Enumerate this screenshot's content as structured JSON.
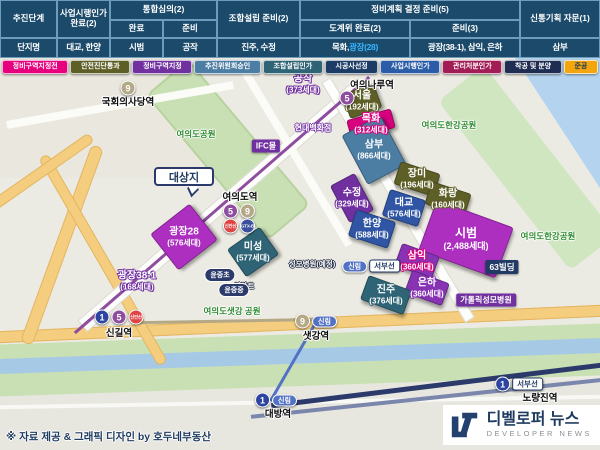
{
  "header_table": {
    "stage_label": "추진단계",
    "g1": "사업시행인가\n완료(2)",
    "g2": "통합심의(2)",
    "g2a": "완료",
    "g2b": "준비",
    "g3": "조합설립 준비(2)",
    "g4": "정비계획 결정 준비(5)",
    "g4a": "도계위 완료(2)",
    "g4b": "준비(3)",
    "g5": "신통기획 자문(1)",
    "complex_label": "단지명",
    "c1": "대교, 한양",
    "c2": "시범",
    "c3": "공작",
    "c4": "진주, 수정",
    "c5a": "목화, ",
    "c5b": "광장(28)",
    "c6": "광장(38-1), 삼익, 은하",
    "c7": "삼부",
    "highlight_color": "#35b6ff"
  },
  "legend": {
    "items": [
      {
        "label": "정비구역지정전",
        "color": "#e6007e"
      },
      {
        "label": "안전진단통과",
        "color": "#5e5f26"
      },
      {
        "label": "정비구역지정",
        "color": "#7030a0"
      },
      {
        "label": "추진위원회승인",
        "color": "#4c7da3"
      },
      {
        "label": "조합설립인가",
        "color": "#2e6475"
      },
      {
        "label": "시공사선정",
        "color": "#1c3c66"
      },
      {
        "label": "사업시행인가",
        "color": "#2a5ca8"
      },
      {
        "label": "관리처분인가",
        "color": "#a21d55"
      },
      {
        "label": "착공 및 분양",
        "color": "#1f2d52"
      },
      {
        "label": "준공",
        "color": "#f2a50c",
        "text": "#16365c"
      }
    ]
  },
  "map": {
    "callout": "대상지",
    "complexes": [
      {
        "name": "서울",
        "units": "(192세대)",
        "x": 362,
        "y": 101,
        "w": 34,
        "h": 26,
        "rot": -20,
        "fill": "#5e5f26"
      },
      {
        "name": "목화",
        "units": "(312세대)",
        "x": 371,
        "y": 124,
        "w": 46,
        "h": 20,
        "rot": -15,
        "fill": "#d6017f"
      },
      {
        "name": "삼부",
        "units": "(866세대)",
        "x": 374,
        "y": 150,
        "w": 44,
        "h": 56,
        "rot": -28,
        "fill": "#4c7da3"
      },
      {
        "name": "장미",
        "units": "(196세대)",
        "x": 417,
        "y": 179,
        "w": 42,
        "h": 24,
        "rot": 18,
        "fill": "#5e5f26"
      },
      {
        "name": "화랑",
        "units": "(160세대)",
        "x": 448,
        "y": 199,
        "w": 42,
        "h": 24,
        "rot": 18,
        "fill": "#5e5f26"
      },
      {
        "name": "수정",
        "units": "(329세대)",
        "x": 352,
        "y": 198,
        "w": 28,
        "h": 42,
        "rot": -28,
        "fill": "#7030a0"
      },
      {
        "name": "대교",
        "units": "(576세대)",
        "x": 404,
        "y": 208,
        "w": 38,
        "h": 28,
        "rot": 18,
        "fill": "#2f55a4"
      },
      {
        "name": "한양",
        "units": "(588세대)",
        "x": 372,
        "y": 229,
        "w": 42,
        "h": 28,
        "rot": 18,
        "fill": "#2f55a4"
      },
      {
        "name": "시범",
        "units": "(2,488세대)",
        "x": 466,
        "y": 239,
        "w": 82,
        "h": 54,
        "rot": 20,
        "fill": "#ad2fc0",
        "big": true
      },
      {
        "name": "삼익",
        "units": "(360세대)",
        "x": 417,
        "y": 261,
        "w": 40,
        "h": 24,
        "rot": 20,
        "fill": "#8733b3",
        "oc": "#d6017f"
      },
      {
        "name": "은하",
        "units": "(360세대)",
        "x": 427,
        "y": 288,
        "w": 40,
        "h": 24,
        "rot": 20,
        "fill": "#8733b3"
      },
      {
        "name": "진주",
        "units": "(376세대)",
        "x": 386,
        "y": 295,
        "w": 46,
        "h": 26,
        "rot": 20,
        "fill": "#2e6475"
      },
      {
        "name": "미성",
        "units": "(577세대)",
        "x": 253,
        "y": 252,
        "w": 40,
        "h": 34,
        "rot": -35,
        "fill": "#2e6475"
      },
      {
        "name": "광장28",
        "units": "(576세대)",
        "x": 184,
        "y": 237,
        "w": 50,
        "h": 46,
        "rot": -38,
        "fill": "#ad2fc0"
      },
      {
        "name": "공작",
        "units": "(373세대)",
        "x": 303,
        "y": 84,
        "noBox": true,
        "oc": "#7030a0"
      },
      {
        "name": "광장38-1",
        "units": "(168세대)",
        "x": 137,
        "y": 281,
        "noBox": true,
        "oc": "#7030a0"
      }
    ],
    "landmarks": [
      {
        "text": "여의도공원",
        "x": 196,
        "y": 134,
        "s": "green"
      },
      {
        "text": "여의도한강공원",
        "x": 449,
        "y": 125,
        "s": "green"
      },
      {
        "text": "여의도한강공원",
        "x": 548,
        "y": 236,
        "s": "green"
      },
      {
        "text": "여의도샛강 공원",
        "x": 232,
        "y": 311,
        "s": "green"
      },
      {
        "text": "현대백화점",
        "x": 313,
        "y": 128,
        "s": "op"
      },
      {
        "text": "IFC몰",
        "x": 266,
        "y": 146,
        "s": "pbox"
      },
      {
        "text": "63빌딩",
        "x": 502,
        "y": 267,
        "s": "nbox"
      },
      {
        "text": "가톨릭성모병원",
        "x": 486,
        "y": 300,
        "s": "pbox"
      },
      {
        "text": "이마트",
        "x": 244,
        "y": 286,
        "s": "od"
      },
      {
        "text": "성모병원(예정)",
        "x": 312,
        "y": 264,
        "s": "od"
      },
      {
        "text": "윤중초",
        "x": 220,
        "y": 275,
        "s": "npill"
      },
      {
        "text": "윤중중",
        "x": 234,
        "y": 290,
        "s": "npill"
      },
      {
        "text": "국회의사당역",
        "x": 128,
        "y": 101,
        "s": "st"
      },
      {
        "text": "여의나루역",
        "x": 372,
        "y": 84,
        "s": "st"
      },
      {
        "text": "여의도역",
        "x": 240,
        "y": 196,
        "s": "st"
      },
      {
        "text": "신길역",
        "x": 119,
        "y": 332,
        "s": "st"
      },
      {
        "text": "샛강역",
        "x": 316,
        "y": 335,
        "s": "st"
      },
      {
        "text": "대방역",
        "x": 278,
        "y": 413,
        "s": "st"
      },
      {
        "text": "노량진역",
        "x": 540,
        "y": 397,
        "s": "st"
      }
    ],
    "badge_clusters": [
      {
        "x": 128,
        "y": 88,
        "b": [
          {
            "t": "c",
            "label": "9",
            "bg": "#b5a887"
          }
        ]
      },
      {
        "x": 347,
        "y": 98,
        "b": [
          {
            "t": "c",
            "label": "5",
            "bg": "#8e4d9e"
          }
        ]
      },
      {
        "x": 239,
        "y": 211,
        "b": [
          {
            "t": "c",
            "label": "5",
            "bg": "#8e4d9e"
          },
          {
            "t": "c",
            "label": "9",
            "bg": "#b5a887"
          }
        ]
      },
      {
        "x": 239,
        "y": 226,
        "b": [
          {
            "t": "c",
            "label": "신안산",
            "bg": "#e04343",
            "tiny": true
          },
          {
            "t": "c",
            "label": "GTX-B",
            "bg": "#3a4f9e",
            "tiny": true
          }
        ]
      },
      {
        "x": 119,
        "y": 317,
        "b": [
          {
            "t": "c",
            "label": "1",
            "bg": "#2c44a0"
          },
          {
            "t": "c",
            "label": "5",
            "bg": "#8e4d9e"
          },
          {
            "t": "c",
            "label": "신안산",
            "bg": "#e04343",
            "tiny": true
          }
        ]
      },
      {
        "x": 316,
        "y": 321,
        "b": [
          {
            "t": "c",
            "label": "9",
            "bg": "#b5a887"
          },
          {
            "t": "p",
            "label": "신림",
            "bg": "#5272c4"
          }
        ]
      },
      {
        "x": 276,
        "y": 400,
        "b": [
          {
            "t": "c",
            "label": "1",
            "bg": "#2c44a0"
          },
          {
            "t": "p",
            "label": "신림",
            "bg": "#5272c4"
          }
        ]
      },
      {
        "x": 519,
        "y": 384,
        "b": [
          {
            "t": "c",
            "label": "1",
            "bg": "#2c44a0"
          },
          {
            "t": "x",
            "label": "서부선"
          }
        ]
      },
      {
        "x": 371,
        "y": 266,
        "b": [
          {
            "t": "p",
            "label": "신림",
            "bg": "#5272c4"
          },
          {
            "t": "x",
            "label": "서부선"
          }
        ]
      }
    ]
  },
  "footer": {
    "credit": "※ 자료 제공 & 그래픽 디자인 by 호두네부동산"
  },
  "logo": {
    "kr": "디벨로퍼 뉴스",
    "en": "DEVELOPER NEWS"
  }
}
